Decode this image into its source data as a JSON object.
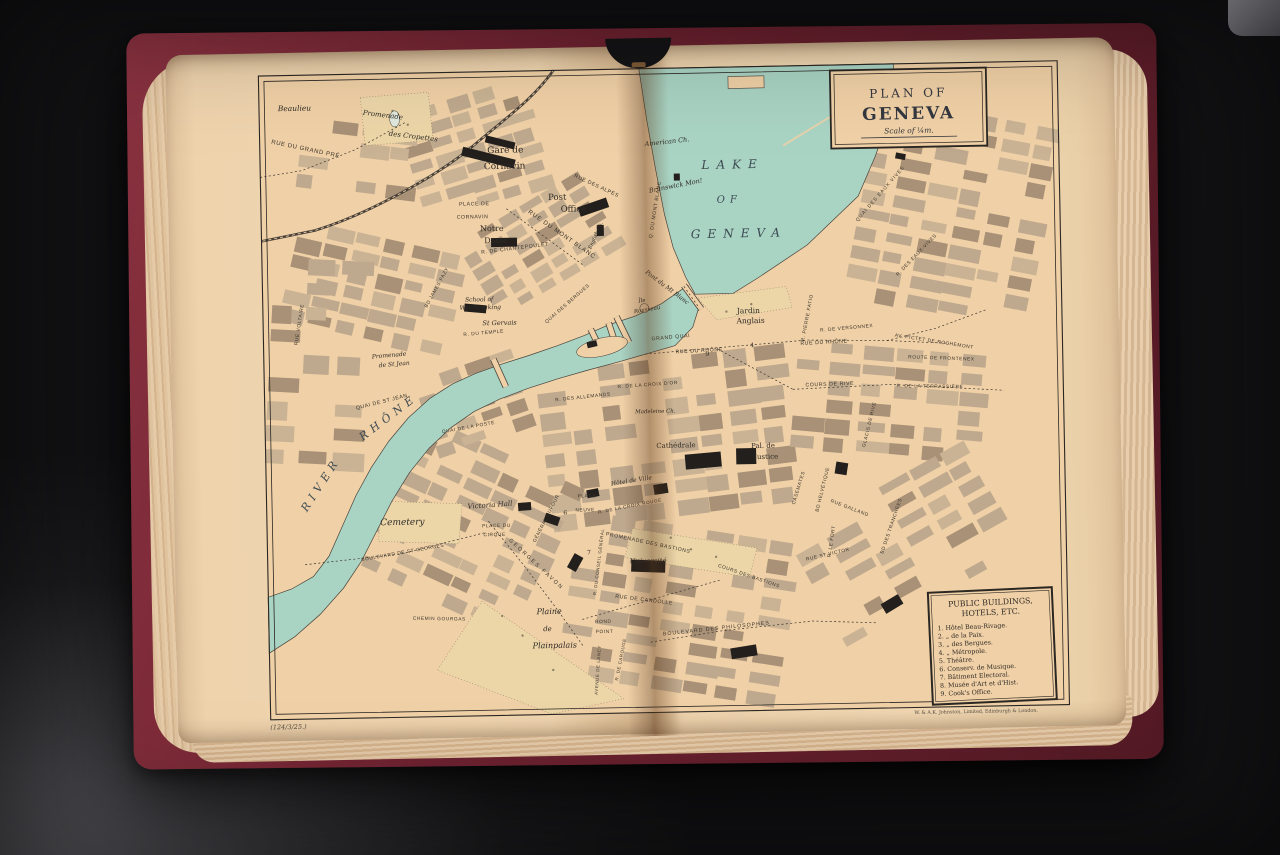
{
  "cartouche": {
    "line1": "PLAN  OF",
    "title": "GENEVA",
    "scale": "Scale of ¼m."
  },
  "legend": {
    "title_line1": "PUBLIC BUILDINGS,",
    "title_line2": "HOTELS,  ETC.",
    "items": [
      "1. Hôtel Beau-Rivage.",
      "2.    „    de la Paix.",
      "3.    „    des Bergues.",
      "4.    „    Métropole.",
      "5. Théâtre.",
      "6. Conserv. de Musique.",
      "7. Bâtiment Electoral.",
      "8. Musée d'Art et d'Hist.",
      "9. Cook's Office."
    ]
  },
  "imprint": "W. & A.K. Johnston, Limited, Edinburgh & London.",
  "plate_number": "(124/3/25.)",
  "map": {
    "labels": {
      "beaulieu": "Beaulieu",
      "rue_du_grand_pre": "RUE DU GRAND PRÉ",
      "promenade_des": "Promenade",
      "cropettes": "des Cropettes",
      "gare_de": "Gare de",
      "cornavin": "Cornavin",
      "place_de": "PLACE DE",
      "place_cornavin": "CORNAVIN",
      "post": "Post",
      "office": "Office",
      "rue_du_mont_blanc": "RUE DU MONT BLANC",
      "notre": "Notre",
      "dame": "Dame",
      "chantepoulet": "R. DE CHANTEPOULET",
      "rue_des_alpes": "RUE DES ALPES",
      "american_ch": "American Ch.",
      "brunswick": "Brunswick Mon!",
      "lake": "LAKE",
      "of": "OF",
      "geneva": "GENEVA",
      "quai_du_mont_blanc": "Q. DU MONT BLANC",
      "pont_du_mt_blanc": "Pont du Mt Blanc",
      "ile": "Île",
      "rousseau": "Rousseau",
      "jardin": "Jardin",
      "anglais": "Anglais",
      "grand_quai": "GRAND QUAI",
      "rue_du_rhone_w": "RUE DU RHÔNE",
      "rue_du_rhone_e": "RUE DU RHÔNE",
      "versonnex": "R. DE VERSONNEX",
      "pierre_fatio": "R. PIERRE FATIO",
      "pictet_rochemont": "AV. PICTET DE ROCHEMONT",
      "frontenex": "ROUTE DE FRONTENEX",
      "cours_de_rive": "COURS DE RIVE",
      "terrassiere": "R. DE LA TERRASSIÈRE",
      "glacis_de_rive": "GLACIS DE RIVE",
      "croix_dor": "R. DE LA CROIX D'OR",
      "allemands": "R. DES ALLEMANDS",
      "madeleine": "Madeleine Ch.",
      "river": "RIVER",
      "rhone": "RHÔNE",
      "quai_st_jean": "QUAI DE ST JEAN",
      "promenade2": "Promenade",
      "de_st_jean": "de St Jean",
      "quai_poste": "QUAI DE LA POSTE",
      "school_of": "School of",
      "watchmaking": "Watchmaking",
      "st_gervais": "St Gervais",
      "rue_du_temple": "R. DU TEMPLE",
      "quai_bergues": "QUAI DES BERGUES",
      "rue_voltaire": "RUE VOLTAIRE",
      "james_fazy": "BD JAMES FAZY",
      "cathedrale": "Cathédrale",
      "pal_de": "Pal. de",
      "justice": "Justice",
      "hotel_de_ville": "Hôtel de Ville",
      "croix_rouge": "R. DE LA CROIX ROUGE",
      "casemates": "CASEMATES",
      "helvetique": "BD HELVÉTIQUE",
      "galland": "RUE GALLAND",
      "le_fort": "R. LE FORT",
      "st_victor": "RUE ST VICTOR",
      "tranchees": "BD DES TRANCHÉES",
      "cours_bastions": "COURS DES BASTIONS",
      "prom_bastions": "PROMENADE DES BASTIONS",
      "universite": "Université",
      "candolle": "RUE DE CANDOLLE",
      "conseil_general": "R. DU CONSEIL GÉNÉRAL",
      "dufour": "GÉNÉRAL DUFOUR",
      "georges_favon": "GEORGES FAVON",
      "st_georges": "BOULEVARD DE ST GEORGES",
      "cemetery": "Cemetery",
      "victoria_hall": "Victoria Hall",
      "place_du": "PLACE DU",
      "cirque": "CIRQUE",
      "place": "PLACE",
      "neuve": "NEUVE",
      "gourgas": "CHEMIN GOURGAS",
      "plaine": "Plaine",
      "de": "de",
      "plainpalais": "Plainpalais",
      "rond": "ROND",
      "point": "POINT",
      "philosophes": "BOULEVARD DES PHILOSOPHES",
      "av_lancy": "AVENUE DE LANCY",
      "carouge": "R. DE CAROUGE",
      "quai_eaux_vives": "QUAI DES EAUX VIVES",
      "rue_eaux_vives": "R. DES EAUX-VIVES",
      "english_ch": "English Ch.",
      "n4": "4",
      "n6": "6",
      "n7": "7",
      "n9": "9"
    }
  },
  "colors": {
    "paper": "#f0d0a6",
    "page": "#f0d6b0",
    "water": "#a9d3c3",
    "block_light": "#bfa98e",
    "block_dark": "#a89176",
    "ink": "#2f2b26",
    "street_ink": "#3b352d",
    "lake_ink": "#3c4a52",
    "cover_red": "#7c2a35",
    "background": "#151517"
  }
}
